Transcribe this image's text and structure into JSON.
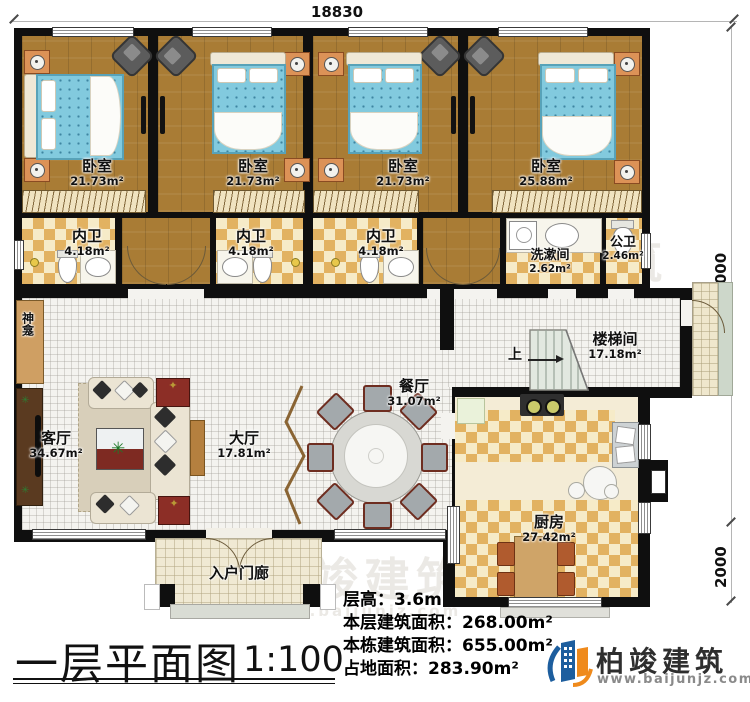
{
  "dims": {
    "top": "18830",
    "right": "14000",
    "right_lower": "2000"
  },
  "rooms": {
    "bedroom1": {
      "name": "卧室",
      "area": "21.73m²"
    },
    "bedroom2": {
      "name": "卧室",
      "area": "21.73m²"
    },
    "bedroom3": {
      "name": "卧室",
      "area": "21.73m²"
    },
    "bedroom4": {
      "name": "卧室",
      "area": "25.88m²"
    },
    "ensuite1": {
      "name": "内卫",
      "area": "4.18m²"
    },
    "ensuite2": {
      "name": "内卫",
      "area": "4.18m²"
    },
    "ensuite3": {
      "name": "内卫",
      "area": "4.18m²"
    },
    "washroom": {
      "name": "洗漱间",
      "area": "2.62m²"
    },
    "public_wc": {
      "name": "公卫",
      "area": "2.46m²"
    },
    "living": {
      "name": "客厅",
      "area": "34.67m²"
    },
    "hall": {
      "name": "大厅",
      "area": "17.81m²"
    },
    "dining": {
      "name": "餐厅",
      "area": "31.07m²"
    },
    "stair": {
      "name": "楼梯间",
      "area": "17.18m²"
    },
    "stair_up": "上",
    "kitchen": {
      "name": "厨房",
      "area": "27.42m²"
    },
    "porch": {
      "name": "入户门廊"
    },
    "shrine": {
      "name": "神龛"
    }
  },
  "title": {
    "text": "一层平面图",
    "scale": "1:100"
  },
  "stats": [
    {
      "label": "层高：",
      "value": "3.6m"
    },
    {
      "label": "本层建筑面积：",
      "value": "268.00m²"
    },
    {
      "label": "本栋建筑面积：",
      "value": "655.00m²"
    },
    {
      "label": "占地面积：",
      "value": "283.90m²"
    }
  ],
  "brand": {
    "name": "柏竣建筑",
    "site": "www.baijunjz.com"
  },
  "watermark": {
    "name": "柏竣建筑",
    "site": "www.baijunjz.com"
  }
}
